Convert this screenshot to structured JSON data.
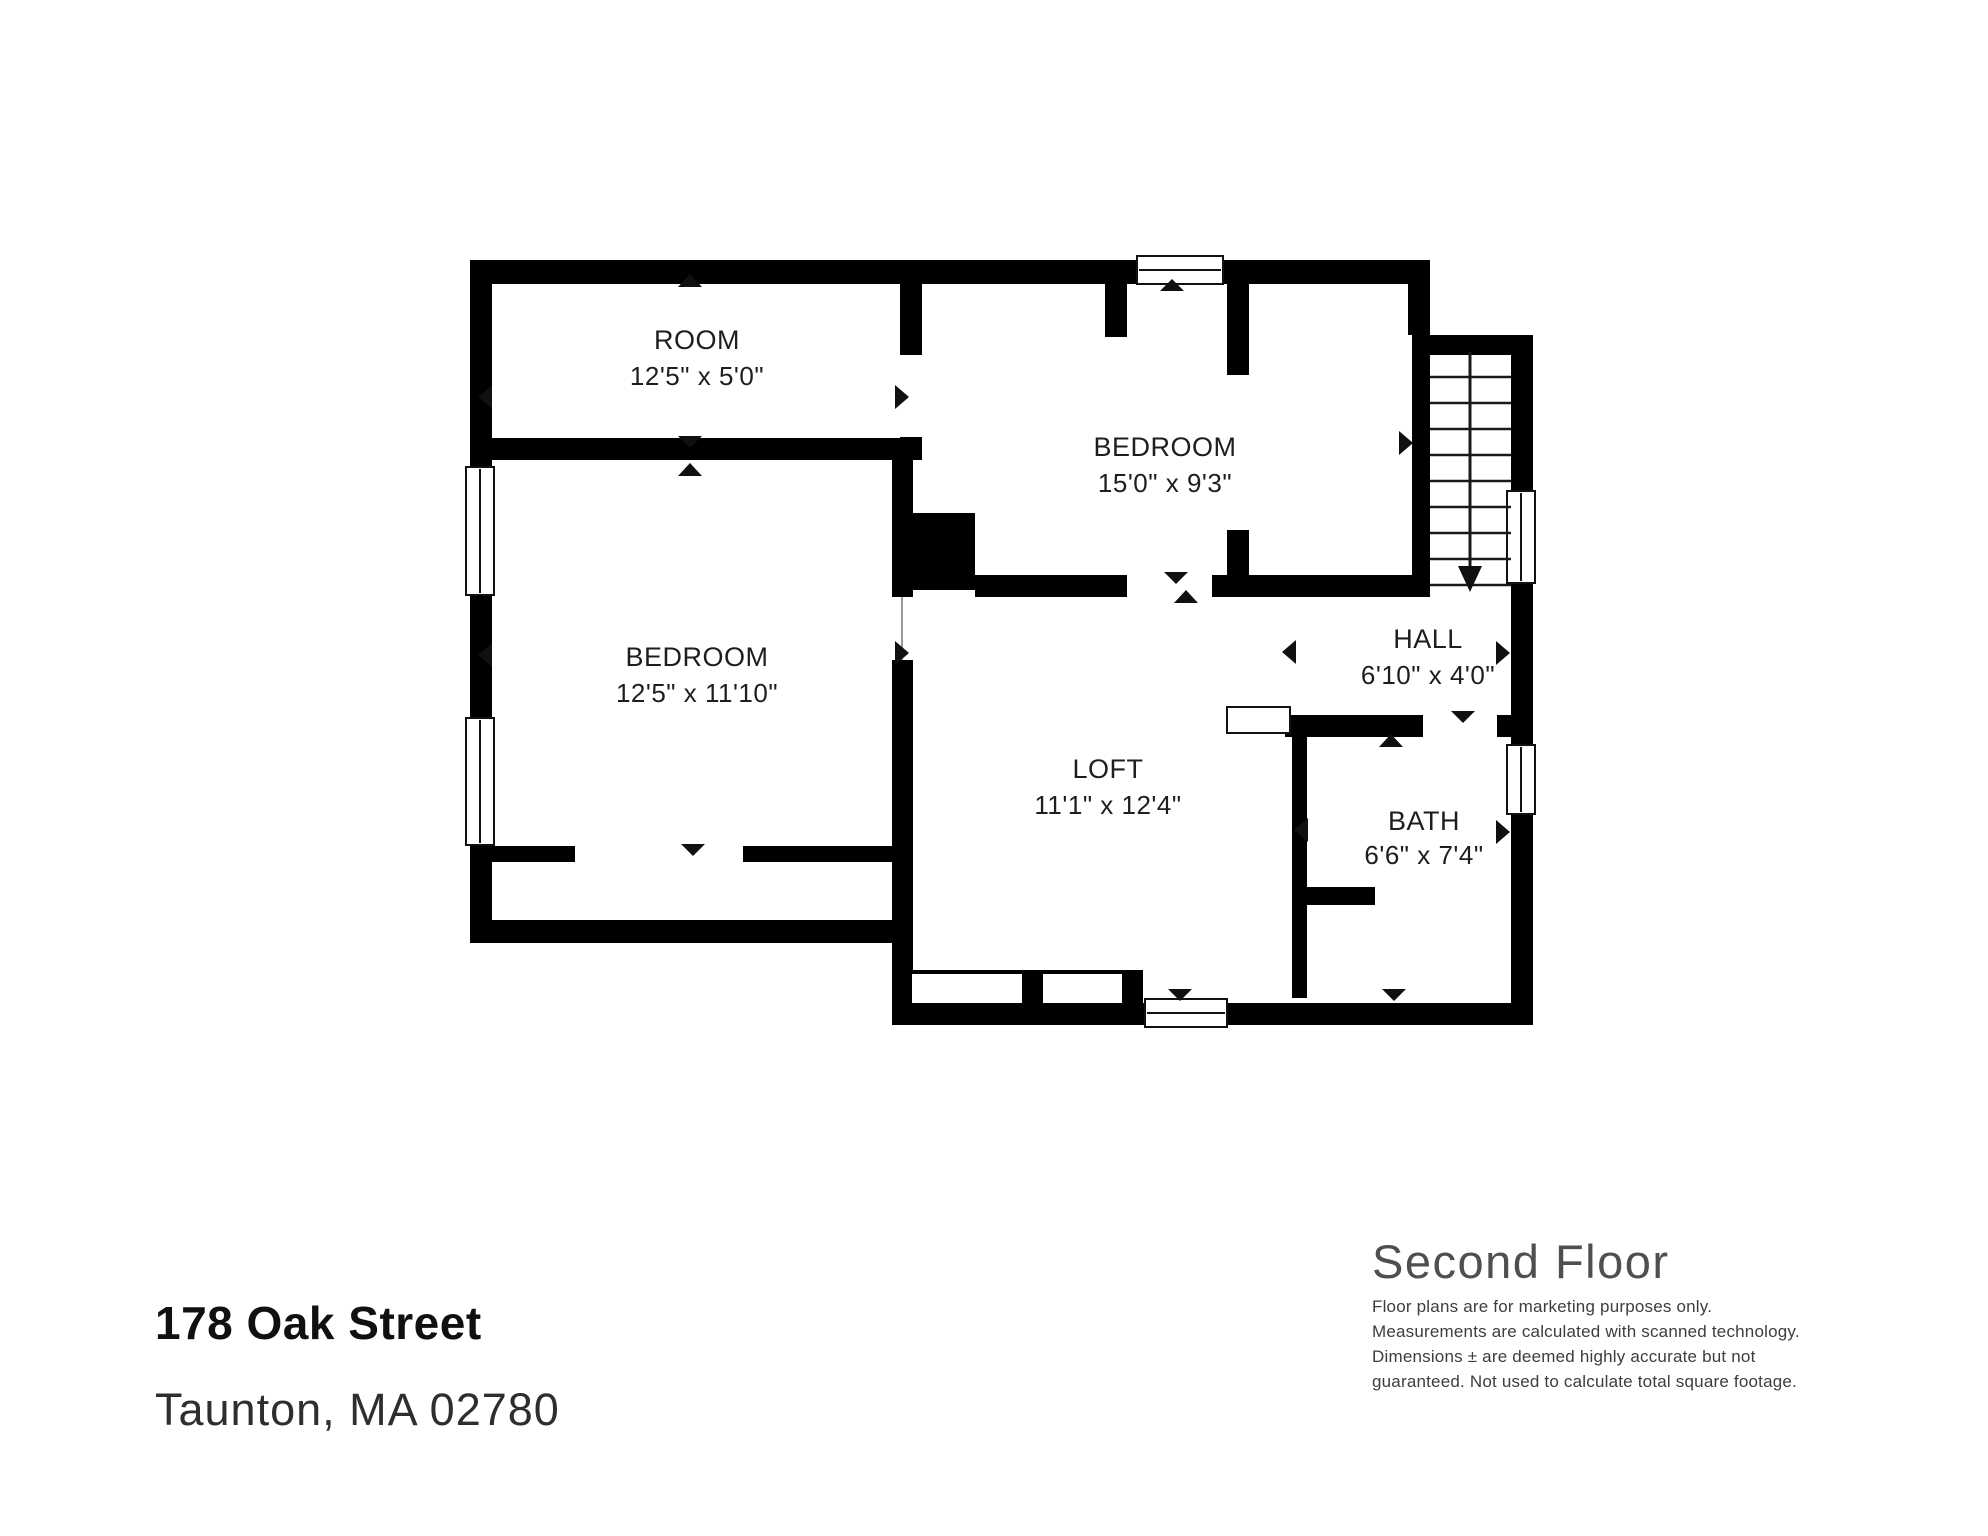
{
  "address": {
    "line1": "178 Oak Street",
    "line2": "Taunton, MA 02780"
  },
  "floor": {
    "title": "Second Floor"
  },
  "disclaimer": {
    "line1": "Floor plans are for marketing purposes only.",
    "line2": "Measurements are calculated with scanned technology.",
    "line3": "Dimensions ± are deemed highly accurate but not",
    "line4": "guaranteed. Not used to calculate total square footage."
  },
  "rooms": {
    "room": {
      "name": "ROOM",
      "dims": "12'5\" x 5'0\""
    },
    "bedroom_top": {
      "name": "BEDROOM",
      "dims": "15'0\" x 9'3\""
    },
    "bedroom_left": {
      "name": "BEDROOM",
      "dims": "12'5\" x 11'10\""
    },
    "hall": {
      "name": "HALL",
      "dims": "6'10\" x 4'0\""
    },
    "loft": {
      "name": "LOFT",
      "dims": "11'1\" x 12'4\""
    },
    "bath": {
      "name": "BATH",
      "dims": "6'6\" x 7'4\""
    }
  },
  "colors": {
    "wall": "#000000",
    "background": "#ffffff",
    "label_text": "#1e1e1e",
    "title_text": "#4f4f4f"
  }
}
